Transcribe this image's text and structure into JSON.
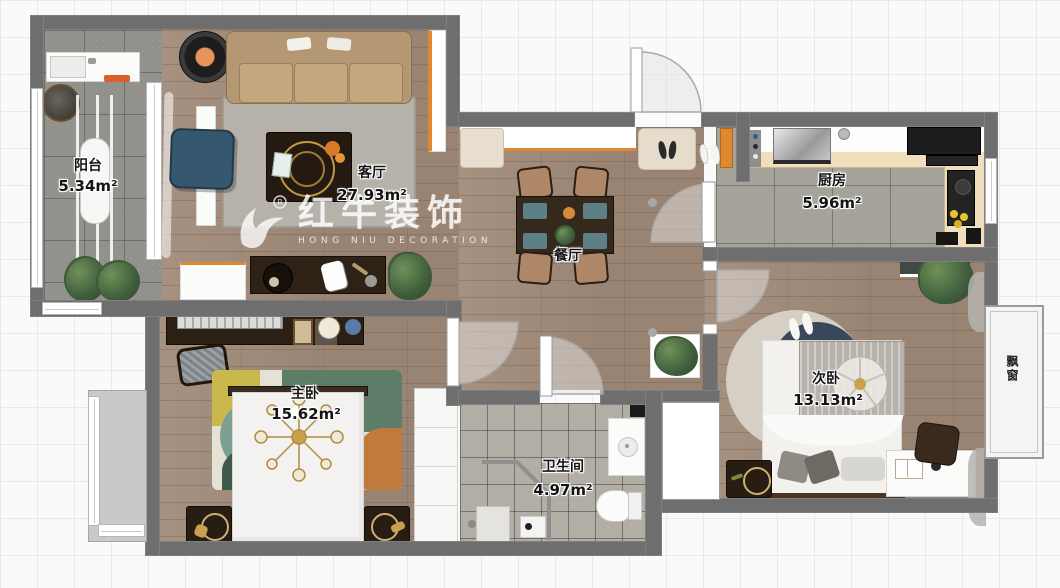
{
  "watermark": {
    "brand": "红牛装饰",
    "subtitle": "HONG NIU DECORATION",
    "reg": "®"
  },
  "rooms": [
    {
      "id": "balcony",
      "name": "阳台",
      "area": "5.34m²"
    },
    {
      "id": "living",
      "name": "客厅",
      "area": "27.93m²"
    },
    {
      "id": "dining",
      "name": "餐厅",
      "area": ""
    },
    {
      "id": "kitchen",
      "name": "厨房",
      "area": "5.96m²"
    },
    {
      "id": "master",
      "name": "主卧",
      "area": "15.62m²"
    },
    {
      "id": "second",
      "name": "次卧",
      "area": "13.13m²"
    },
    {
      "id": "bath",
      "name": "卫生间",
      "area": "4.97m²"
    },
    {
      "id": "bay",
      "name": "飘窗",
      "area": ""
    }
  ],
  "colors": {
    "wall": "#6e6e6e",
    "accent_orange": "#e0882f",
    "wood": "#a18b7a"
  }
}
